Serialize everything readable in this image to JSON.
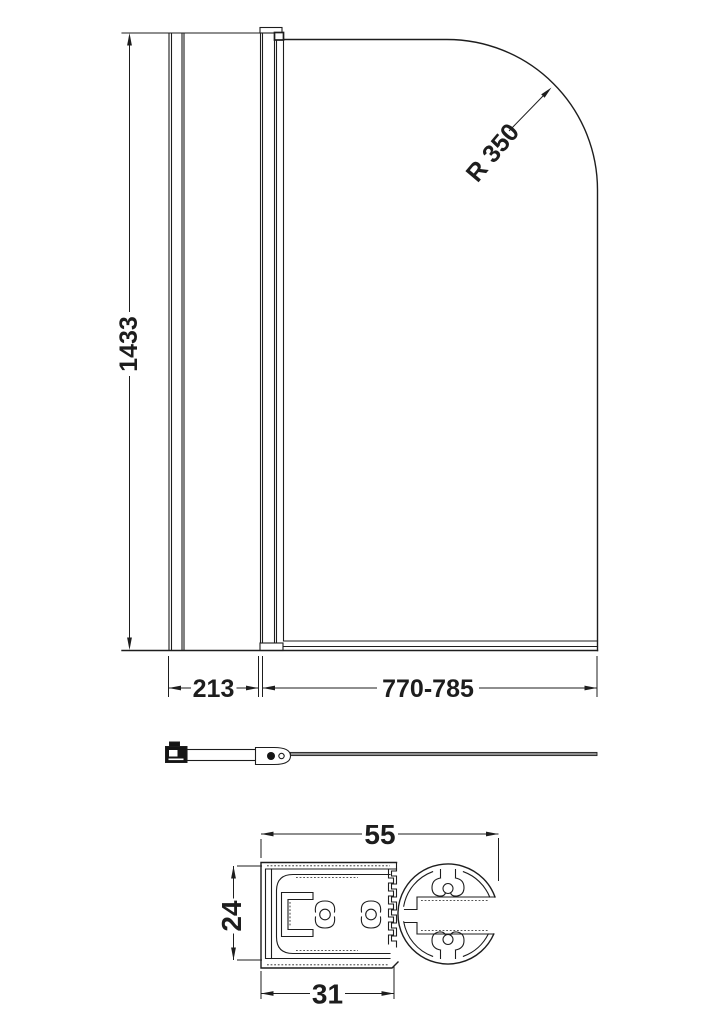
{
  "drawing_title": "Curved bath shower screen technical drawing",
  "front_view": {
    "height_label": "1433",
    "panel_width_label": "213",
    "screen_width_label": "770-785",
    "radius_label": "R 350"
  },
  "section_view": {
    "width_label": "55",
    "depth_label": "24",
    "base_width_label": "31"
  },
  "colors": {
    "line": "#1d1d1d",
    "glass_fill": "#8f8f8f",
    "fitting_fill": "#141414",
    "background": "#ffffff"
  }
}
